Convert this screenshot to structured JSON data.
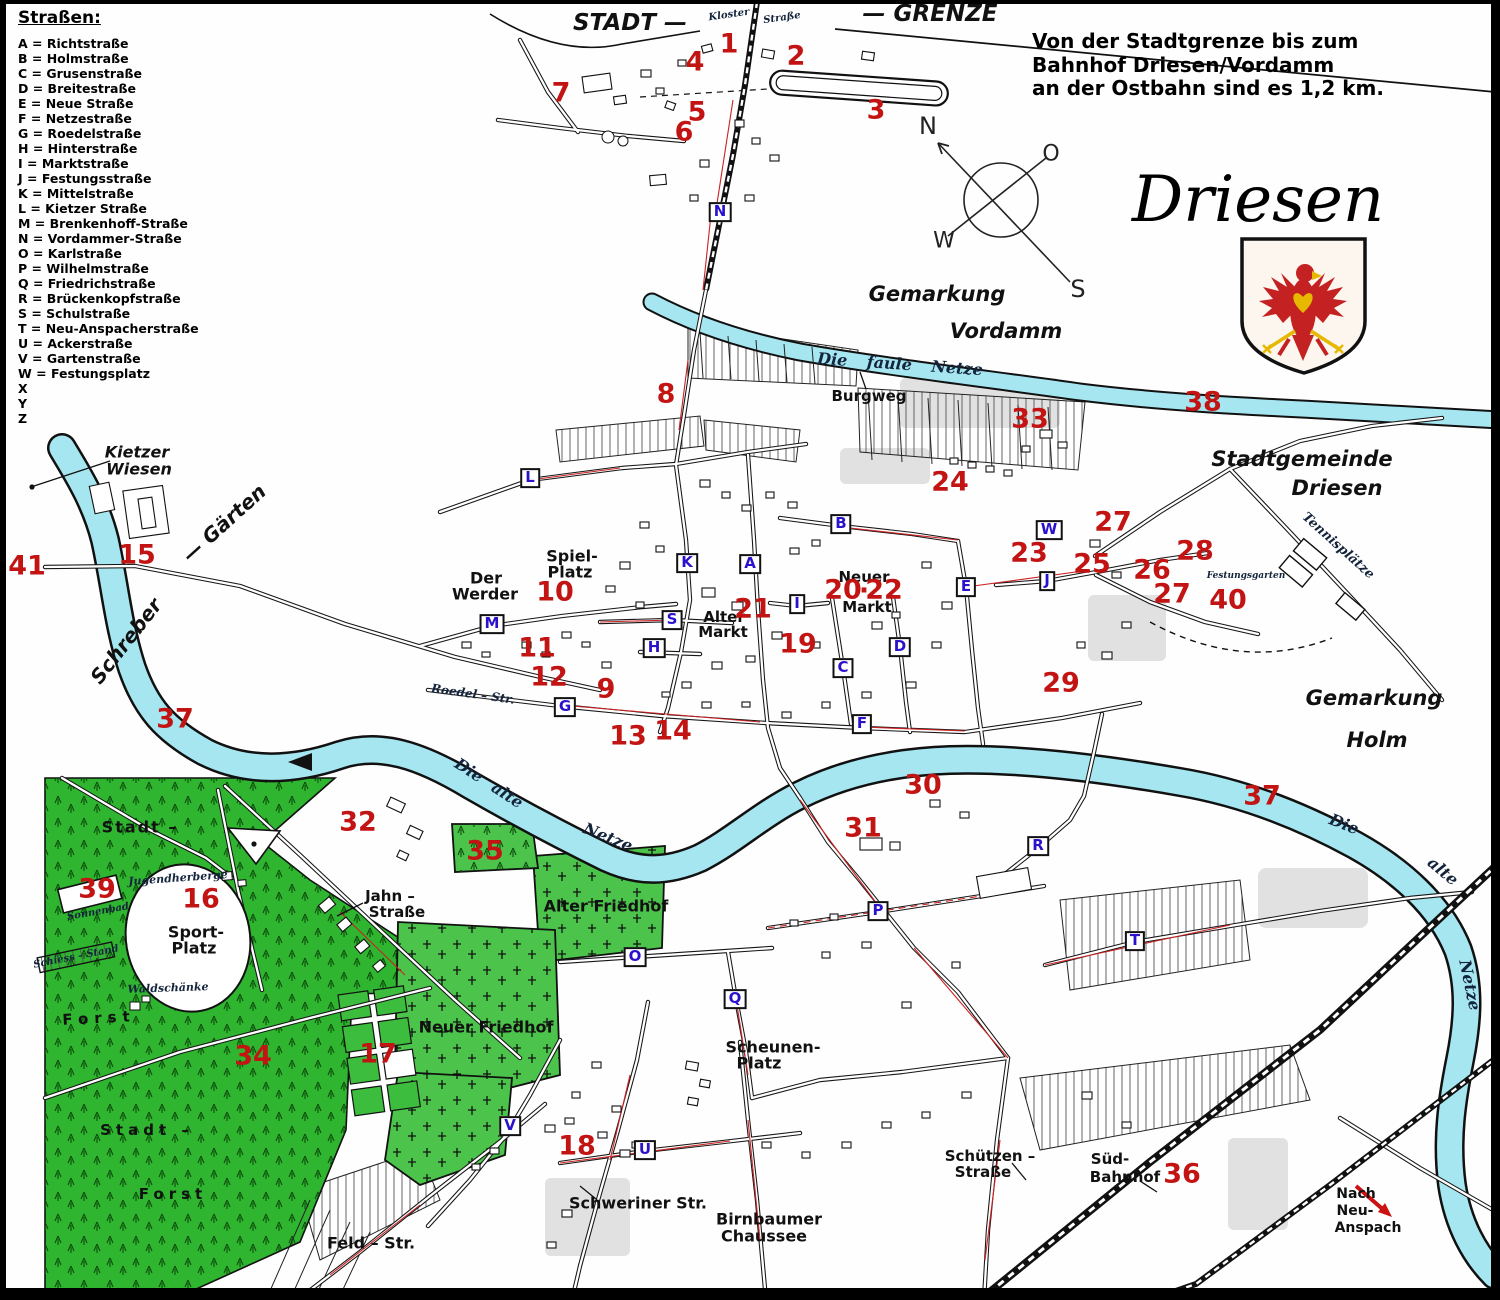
{
  "legend": {
    "title": "Straßen:",
    "items": [
      {
        "key": "A",
        "name": "Richtstraße"
      },
      {
        "key": "B",
        "name": "Holmstraße"
      },
      {
        "key": "C",
        "name": "Grusenstraße"
      },
      {
        "key": "D",
        "name": "Breitestraße"
      },
      {
        "key": "E",
        "name": "Neue Straße"
      },
      {
        "key": "F",
        "name": "Netzestraße"
      },
      {
        "key": "G",
        "name": "Roedelstraße"
      },
      {
        "key": "H",
        "name": "Hinterstraße"
      },
      {
        "key": "I",
        "name": "Marktstraße"
      },
      {
        "key": "J",
        "name": "Festungsstraße"
      },
      {
        "key": "K",
        "name": "Mittelstraße"
      },
      {
        "key": "L",
        "name": "Kietzer Straße"
      },
      {
        "key": "M",
        "name": "Brenkenhoff-Straße"
      },
      {
        "key": "N",
        "name": "Vordammer-Straße"
      },
      {
        "key": "O",
        "name": "Karlstraße"
      },
      {
        "key": "P",
        "name": "Wilhelmstraße"
      },
      {
        "key": "Q",
        "name": "Friedrichstraße"
      },
      {
        "key": "R",
        "name": "Brückenkopfstraße"
      },
      {
        "key": "S",
        "name": "Schulstraße"
      },
      {
        "key": "T",
        "name": "Neu-Anspacherstraße"
      },
      {
        "key": "U",
        "name": "Ackerstraße"
      },
      {
        "key": "V",
        "name": "Gartenstraße"
      },
      {
        "key": "W",
        "name": "Festungsplatz"
      },
      {
        "key": "X",
        "name": ""
      },
      {
        "key": "Y",
        "name": ""
      },
      {
        "key": "Z",
        "name": ""
      }
    ]
  },
  "header": {
    "title": "Driesen",
    "note_lines": [
      "Von der Stadtgrenze bis zum",
      "Bahnhof Driesen/Vordamm",
      "an der Ostbahn sind es 1,2 km."
    ]
  },
  "map_labels": [
    {
      "t": "STADT —",
      "x": 630,
      "y": 23,
      "s": 23,
      "c": "region"
    },
    {
      "t": "— GRENZE",
      "x": 930,
      "y": 14,
      "s": 23,
      "c": "region"
    },
    {
      "t": "Gemarkung",
      "x": 937,
      "y": 294,
      "s": 21,
      "c": "region"
    },
    {
      "t": "Vordamm",
      "x": 1006,
      "y": 331,
      "s": 21,
      "c": "region"
    },
    {
      "t": "Stadtgemeinde",
      "x": 1302,
      "y": 459,
      "s": 21,
      "c": "region"
    },
    {
      "t": "Driesen",
      "x": 1337,
      "y": 488,
      "s": 21,
      "c": "region"
    },
    {
      "t": "Gemarkung",
      "x": 1374,
      "y": 698,
      "s": 21,
      "c": "region"
    },
    {
      "t": "Holm",
      "x": 1377,
      "y": 740,
      "s": 21,
      "c": "region"
    },
    {
      "t": "Kietzer",
      "x": 137,
      "y": 452,
      "s": 16,
      "c": "region"
    },
    {
      "t": "Wiesen",
      "x": 139,
      "y": 469,
      "s": 16,
      "c": "region"
    },
    {
      "t": "Schreber",
      "x": 126,
      "y": 641,
      "s": 20,
      "r": -52,
      "c": "region"
    },
    {
      "t": "— Gärten",
      "x": 224,
      "y": 523,
      "s": 20,
      "r": -42,
      "c": "region"
    },
    {
      "t": "Burgweg",
      "x": 869,
      "y": 396,
      "s": 15,
      "c": "place"
    },
    {
      "t": "Spiel-",
      "x": 572,
      "y": 556,
      "s": 16,
      "c": "place"
    },
    {
      "t": "Platz",
      "x": 570,
      "y": 572,
      "s": 16,
      "c": "place"
    },
    {
      "t": "Der",
      "x": 486,
      "y": 578,
      "s": 16,
      "c": "place"
    },
    {
      "t": "Werder",
      "x": 485,
      "y": 594,
      "s": 16,
      "c": "place"
    },
    {
      "t": "Alter",
      "x": 724,
      "y": 617,
      "s": 15,
      "c": "place"
    },
    {
      "t": "Markt",
      "x": 723,
      "y": 632,
      "s": 15,
      "c": "place"
    },
    {
      "t": "Neuer",
      "x": 864,
      "y": 577,
      "s": 15,
      "c": "place"
    },
    {
      "t": "Markt",
      "x": 867,
      "y": 607,
      "s": 15,
      "c": "place"
    },
    {
      "t": "Scheunen-",
      "x": 773,
      "y": 1047,
      "s": 16,
      "c": "place"
    },
    {
      "t": "Platz",
      "x": 759,
      "y": 1063,
      "s": 16,
      "c": "place"
    },
    {
      "t": "Jahn –",
      "x": 390,
      "y": 896,
      "s": 15,
      "c": "place"
    },
    {
      "t": "Straße",
      "x": 397,
      "y": 912,
      "s": 15,
      "c": "place"
    },
    {
      "t": "Sport-",
      "x": 196,
      "y": 932,
      "s": 16,
      "c": "place"
    },
    {
      "t": "Platz",
      "x": 194,
      "y": 948,
      "s": 16,
      "c": "place"
    },
    {
      "t": "Stadt –",
      "x": 140,
      "y": 827,
      "s": 16,
      "ls": 2,
      "c": "place"
    },
    {
      "t": "Forst",
      "x": 99,
      "y": 1018,
      "s": 15,
      "ls": 6,
      "r": -3,
      "c": "place"
    },
    {
      "t": "Stadt –",
      "x": 147,
      "y": 1130,
      "s": 15,
      "ls": 5,
      "c": "place"
    },
    {
      "t": "Forst",
      "x": 173,
      "y": 1194,
      "s": 15,
      "ls": 5,
      "c": "place"
    },
    {
      "t": "Alter Friedhof",
      "x": 606,
      "y": 906,
      "s": 16,
      "c": "place"
    },
    {
      "t": "Neuer Friedhof",
      "x": 486,
      "y": 1027,
      "s": 16,
      "c": "place"
    },
    {
      "t": "Schweriner Str.",
      "x": 638,
      "y": 1203,
      "s": 16,
      "c": "place"
    },
    {
      "t": "Feld – Str.",
      "x": 371,
      "y": 1243,
      "s": 16,
      "c": "place"
    },
    {
      "t": "Birnbaumer",
      "x": 769,
      "y": 1219,
      "s": 16,
      "c": "place"
    },
    {
      "t": "Chaussee",
      "x": 764,
      "y": 1236,
      "s": 16,
      "c": "place"
    },
    {
      "t": "Schützen –",
      "x": 990,
      "y": 1156,
      "s": 15,
      "c": "place"
    },
    {
      "t": "Straße",
      "x": 983,
      "y": 1172,
      "s": 15,
      "c": "place"
    },
    {
      "t": "Süd-",
      "x": 1110,
      "y": 1159,
      "s": 15,
      "c": "place"
    },
    {
      "t": "Bahnhof",
      "x": 1125,
      "y": 1177,
      "s": 15,
      "c": "place"
    },
    {
      "t": "Nach",
      "x": 1356,
      "y": 1194,
      "s": 14,
      "c": "place"
    },
    {
      "t": "Neu-",
      "x": 1355,
      "y": 1211,
      "s": 14,
      "c": "place"
    },
    {
      "t": "Anspach",
      "x": 1368,
      "y": 1228,
      "s": 14,
      "c": "place"
    },
    {
      "t": "Die faule Netze",
      "x": 900,
      "y": 364,
      "s": 16,
      "r": 4,
      "ws": 14,
      "c": "cursive"
    },
    {
      "t": "Die alte",
      "x": 489,
      "y": 783,
      "s": 16,
      "r": 33,
      "ws": 8,
      "c": "cursive"
    },
    {
      "t": "Netze",
      "x": 608,
      "y": 837,
      "s": 16,
      "r": 22,
      "c": "cursive"
    },
    {
      "t": "Die",
      "x": 1344,
      "y": 824,
      "s": 16,
      "r": 22,
      "c": "cursive"
    },
    {
      "t": "alte",
      "x": 1443,
      "y": 871,
      "s": 16,
      "r": 40,
      "c": "cursive"
    },
    {
      "t": "Netze",
      "x": 1470,
      "y": 985,
      "s": 16,
      "r": 78,
      "c": "cursive"
    },
    {
      "t": "Tennisplätze",
      "x": 1338,
      "y": 546,
      "s": 13,
      "r": 42,
      "c": "cursive"
    },
    {
      "t": "Festungsgarten",
      "x": 1246,
      "y": 576,
      "s": 9,
      "c": "cursive"
    },
    {
      "t": "Jugendherberge",
      "x": 178,
      "y": 878,
      "s": 11,
      "r": -4,
      "c": "cursive"
    },
    {
      "t": "Sonnenbad",
      "x": 98,
      "y": 912,
      "s": 10,
      "r": -10,
      "c": "cursive"
    },
    {
      "t": "Schiess – Stand",
      "x": 76,
      "y": 957,
      "s": 10,
      "r": -11,
      "c": "cursive"
    },
    {
      "t": "Waldschänke",
      "x": 168,
      "y": 988,
      "s": 11,
      "r": -2,
      "c": "cursive"
    },
    {
      "t": "Roedel – Str.",
      "x": 473,
      "y": 694,
      "s": 12,
      "r": 8,
      "c": "cursive"
    },
    {
      "t": "Kloster",
      "x": 729,
      "y": 15,
      "s": 10,
      "r": -8,
      "c": "cursive"
    },
    {
      "t": "Straße",
      "x": 782,
      "y": 18,
      "s": 10,
      "r": -8,
      "c": "cursive"
    },
    {
      "t": "N",
      "x": 928,
      "y": 126,
      "s": 24,
      "c": "compass"
    },
    {
      "t": "O",
      "x": 1051,
      "y": 154,
      "s": 22,
      "c": "compass"
    },
    {
      "t": "W",
      "x": 944,
      "y": 241,
      "s": 22,
      "c": "compass"
    },
    {
      "t": "S",
      "x": 1078,
      "y": 289,
      "s": 24,
      "c": "compass"
    }
  ],
  "red_numbers": [
    {
      "n": "1",
      "x": 729,
      "y": 44
    },
    {
      "n": "2",
      "x": 796,
      "y": 56
    },
    {
      "n": "3",
      "x": 876,
      "y": 110
    },
    {
      "n": "4",
      "x": 695,
      "y": 62
    },
    {
      "n": "5",
      "x": 697,
      "y": 112
    },
    {
      "n": "6",
      "x": 684,
      "y": 132
    },
    {
      "n": "7",
      "x": 561,
      "y": 93
    },
    {
      "n": "8",
      "x": 666,
      "y": 394
    },
    {
      "n": "9",
      "x": 606,
      "y": 689
    },
    {
      "n": "10",
      "x": 555,
      "y": 592
    },
    {
      "n": "11",
      "x": 537,
      "y": 648
    },
    {
      "n": "12",
      "x": 549,
      "y": 677
    },
    {
      "n": "13",
      "x": 628,
      "y": 736
    },
    {
      "n": "14",
      "x": 673,
      "y": 731
    },
    {
      "n": "15",
      "x": 137,
      "y": 555
    },
    {
      "n": "16",
      "x": 201,
      "y": 899
    },
    {
      "n": "17",
      "x": 378,
      "y": 1054
    },
    {
      "n": "18",
      "x": 577,
      "y": 1146
    },
    {
      "n": "19",
      "x": 798,
      "y": 644
    },
    {
      "n": "20",
      "x": 843,
      "y": 590
    },
    {
      "n": "·",
      "x": 864,
      "y": 591
    },
    {
      "n": "22",
      "x": 884,
      "y": 590
    },
    {
      "n": "21",
      "x": 753,
      "y": 609
    },
    {
      "n": "23",
      "x": 1029,
      "y": 553
    },
    {
      "n": "24",
      "x": 950,
      "y": 482
    },
    {
      "n": "25",
      "x": 1092,
      "y": 564
    },
    {
      "n": "26",
      "x": 1152,
      "y": 570
    },
    {
      "n": "27",
      "x": 1113,
      "y": 522
    },
    {
      "n": "27",
      "x": 1172,
      "y": 594
    },
    {
      "n": "28",
      "x": 1195,
      "y": 551
    },
    {
      "n": "29",
      "x": 1061,
      "y": 683
    },
    {
      "n": "30",
      "x": 923,
      "y": 785
    },
    {
      "n": "31",
      "x": 863,
      "y": 828
    },
    {
      "n": "32",
      "x": 358,
      "y": 822
    },
    {
      "n": "33",
      "x": 1030,
      "y": 419
    },
    {
      "n": "34",
      "x": 253,
      "y": 1056
    },
    {
      "n": "35",
      "x": 485,
      "y": 851
    },
    {
      "n": "36",
      "x": 1182,
      "y": 1174
    },
    {
      "n": "37",
      "x": 175,
      "y": 719
    },
    {
      "n": "37",
      "x": 1262,
      "y": 796
    },
    {
      "n": "38",
      "x": 1203,
      "y": 402
    },
    {
      "n": "39",
      "x": 97,
      "y": 889
    },
    {
      "n": "40",
      "x": 1228,
      "y": 600
    },
    {
      "n": "41",
      "x": 27,
      "y": 566
    }
  ],
  "street_letters": [
    {
      "l": "A",
      "x": 750,
      "y": 564
    },
    {
      "l": "B",
      "x": 841,
      "y": 524
    },
    {
      "l": "C",
      "x": 843,
      "y": 668
    },
    {
      "l": "D",
      "x": 900,
      "y": 647
    },
    {
      "l": "E",
      "x": 966,
      "y": 587
    },
    {
      "l": "F",
      "x": 862,
      "y": 724
    },
    {
      "l": "G",
      "x": 565,
      "y": 707
    },
    {
      "l": "H",
      "x": 654,
      "y": 648
    },
    {
      "l": "I",
      "x": 797,
      "y": 604
    },
    {
      "l": "J",
      "x": 1047,
      "y": 581
    },
    {
      "l": "K",
      "x": 687,
      "y": 563
    },
    {
      "l": "L",
      "x": 530,
      "y": 478
    },
    {
      "l": "M",
      "x": 492,
      "y": 624
    },
    {
      "l": "N",
      "x": 720,
      "y": 212
    },
    {
      "l": "O",
      "x": 635,
      "y": 957
    },
    {
      "l": "P",
      "x": 878,
      "y": 911
    },
    {
      "l": "Q",
      "x": 735,
      "y": 999
    },
    {
      "l": "R",
      "x": 1038,
      "y": 846
    },
    {
      "l": "S",
      "x": 672,
      "y": 620
    },
    {
      "l": "T",
      "x": 1135,
      "y": 941
    },
    {
      "l": "U",
      "x": 645,
      "y": 1150
    },
    {
      "l": "V",
      "x": 510,
      "y": 1126
    },
    {
      "l": "W",
      "x": 1049,
      "y": 530
    }
  ]
}
